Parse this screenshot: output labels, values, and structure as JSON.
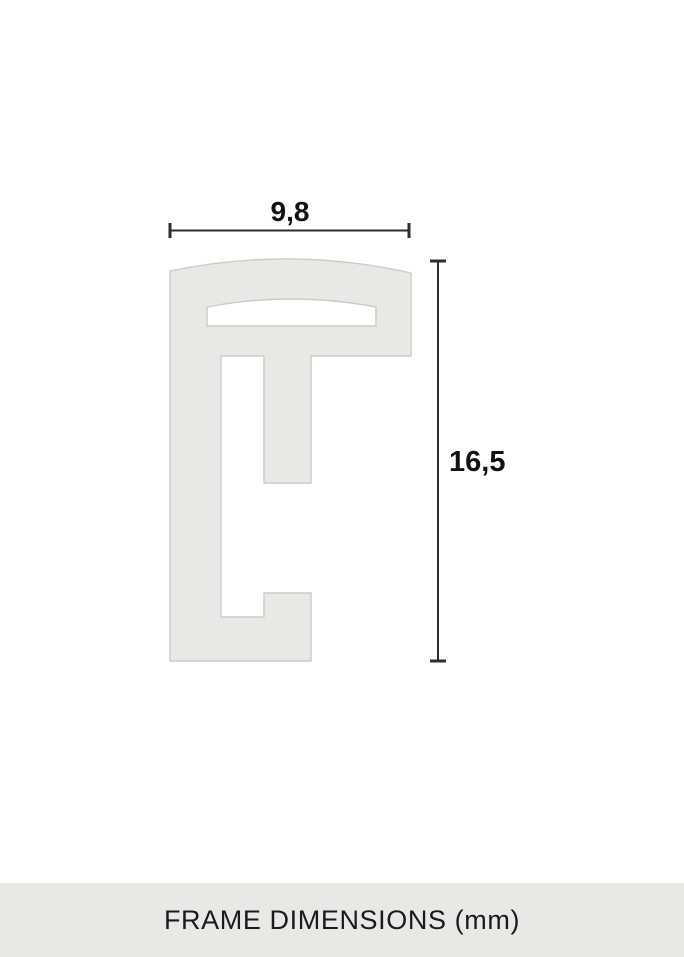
{
  "diagram": {
    "width_label": "9,8",
    "height_label": "16,5",
    "shape_fill": "#e9e8e5",
    "shape_stroke": "#cbcbc8",
    "slot_fill": "#ffffff",
    "line_color": "#2e2e2e",
    "label_color": "#121212"
  },
  "footer": {
    "title": "FRAME DIMENSIONS (mm)",
    "background": "#e9e8e4",
    "text_color": "#1b1b1b"
  }
}
